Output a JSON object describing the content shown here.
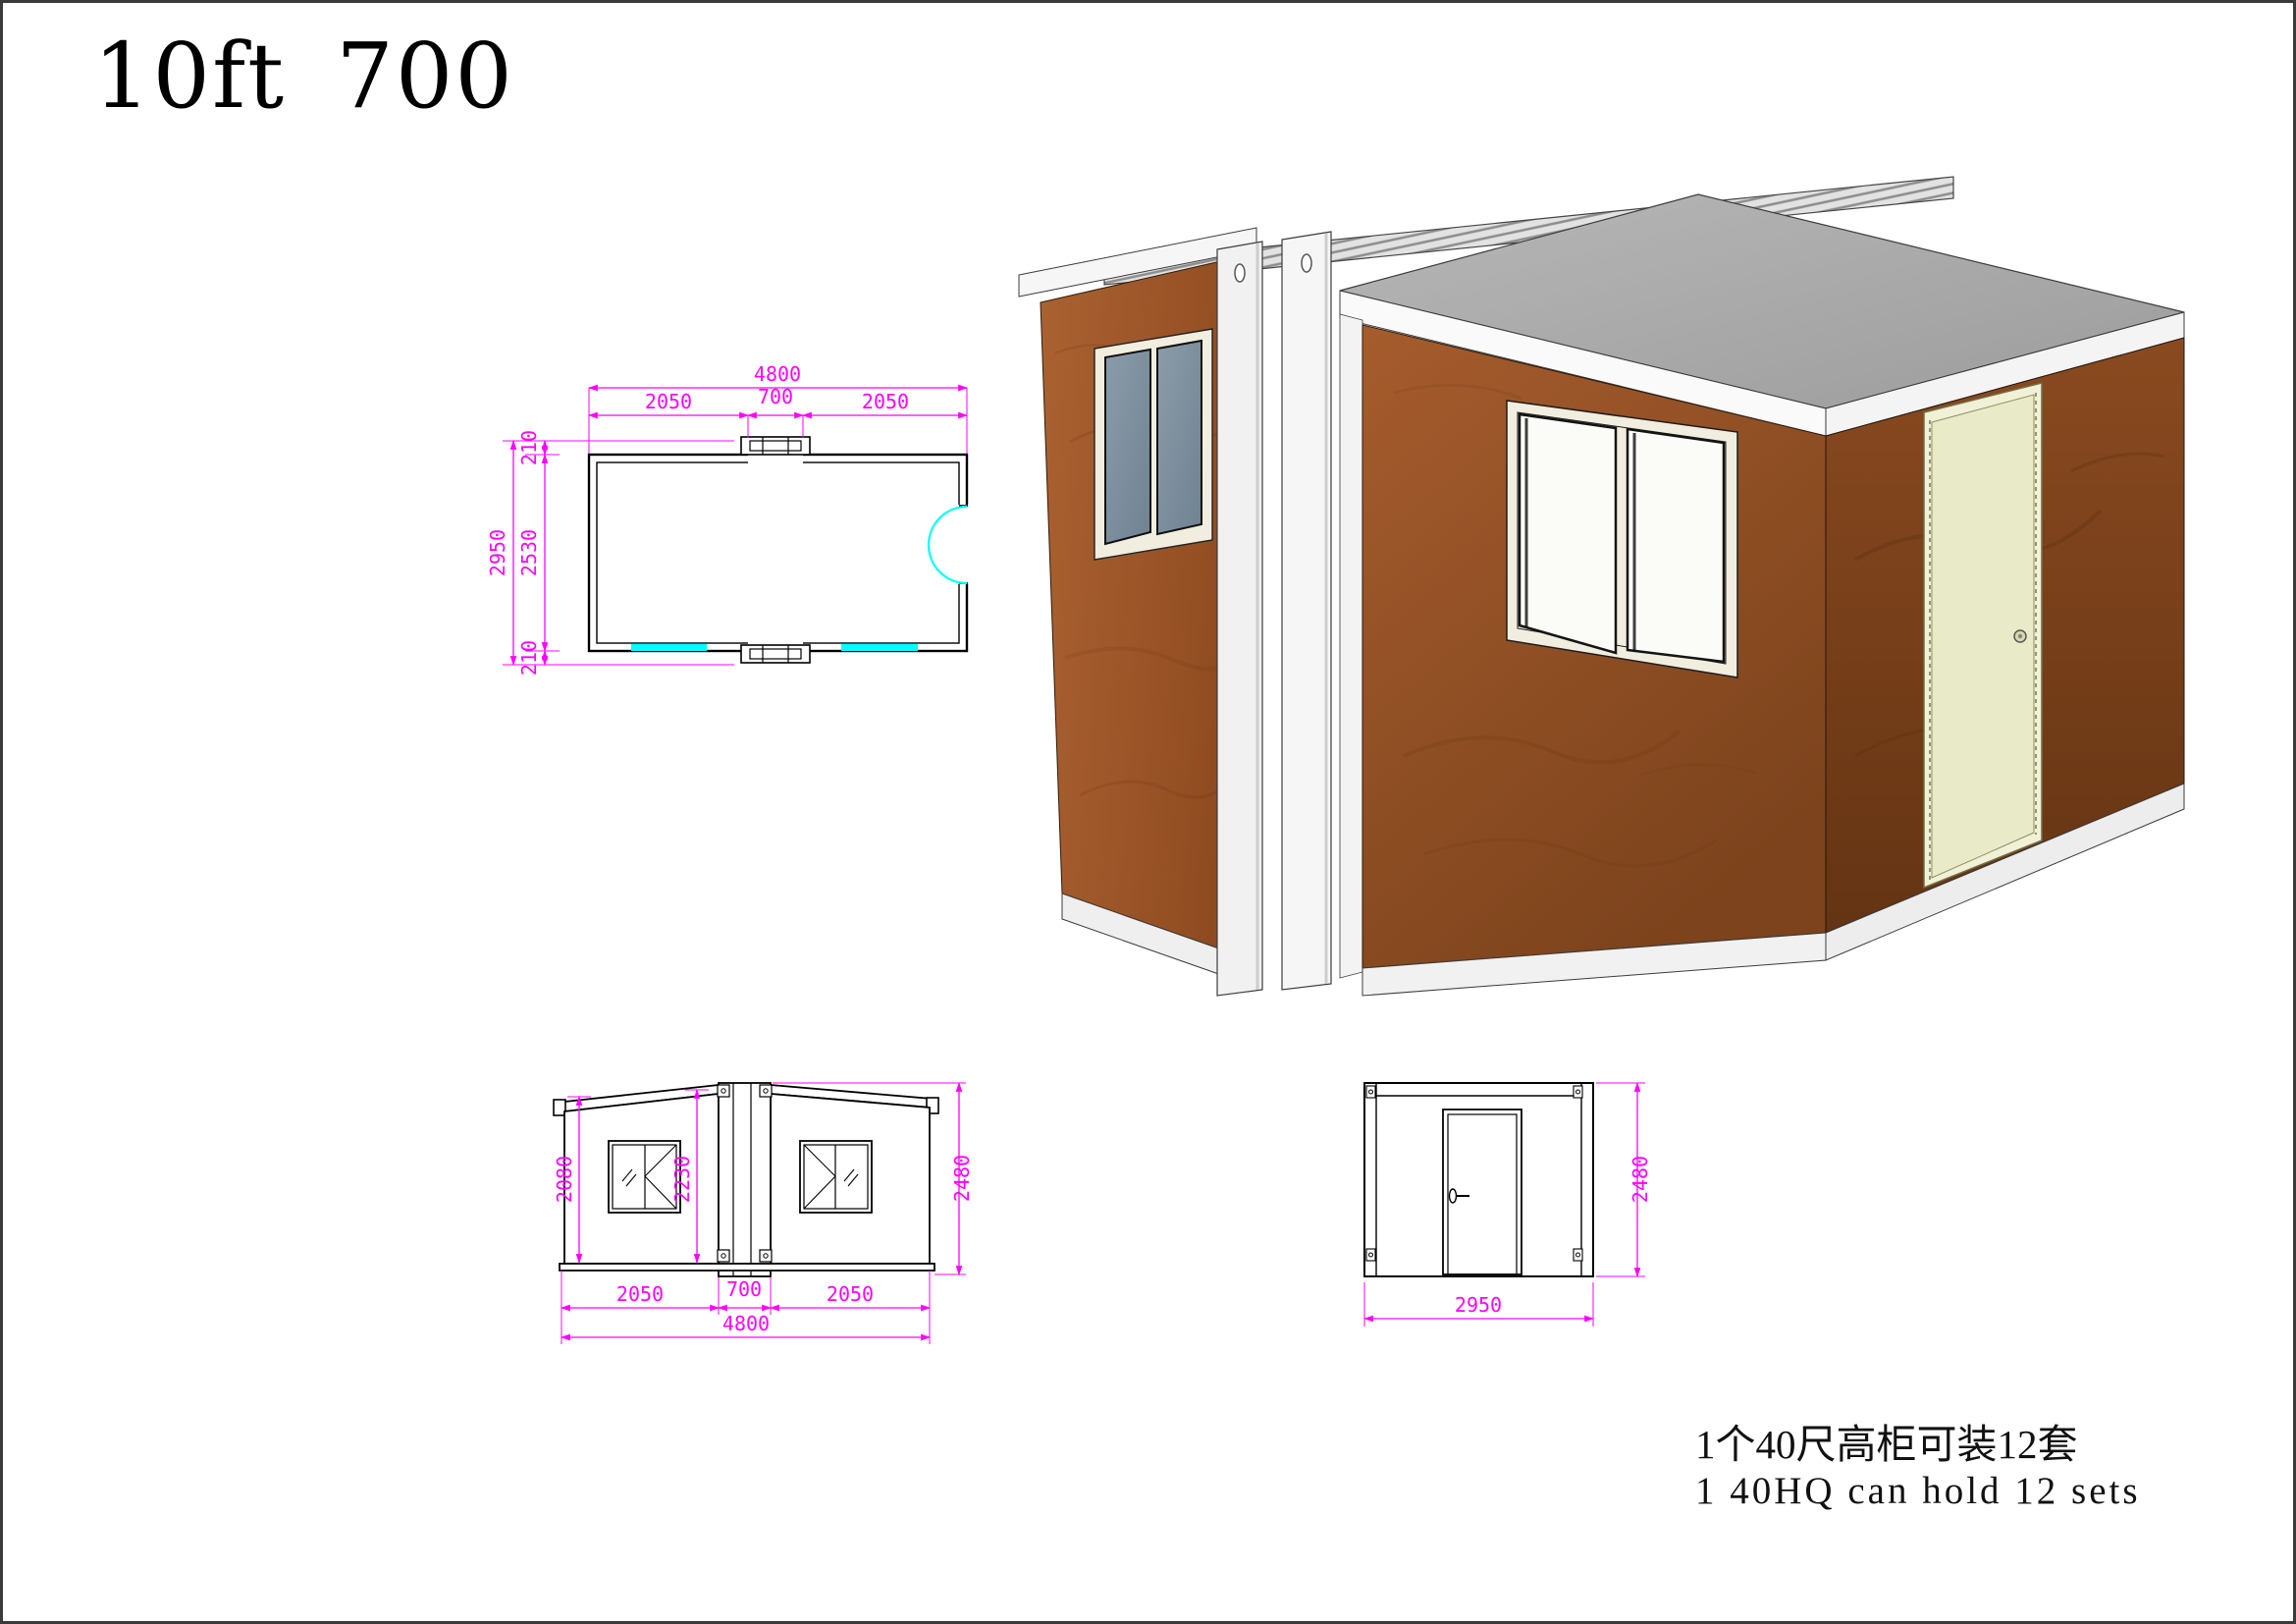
{
  "page": {
    "title": "10ft 700"
  },
  "colors": {
    "dimension_magenta": "#FF00FF",
    "window_marker_cyan": "#00FFFF",
    "drawing_line": "#000000",
    "wall_wood_brown": "#A0582B",
    "roof_gray": "#ABABAB",
    "trim_white": "#F4F4F4",
    "door_cream": "#E9EBC8",
    "glass_blue_gray": "#7E8E9B"
  },
  "floor_plan": {
    "total_width": "4800",
    "left_width": "2050",
    "center_width": "700",
    "right_width": "2050",
    "total_height": "2950",
    "top_offset": "210",
    "inner_height": "2530",
    "bottom_offset": "210"
  },
  "front_elevation": {
    "wall_height": "2080",
    "center_height": "2230",
    "overall_height": "2480",
    "left_width": "2050",
    "center_width": "700",
    "right_width": "2050",
    "total_width": "4800"
  },
  "side_elevation": {
    "width": "2950",
    "height": "2480"
  },
  "notes": {
    "capacity_zh": "1个40尺高柜可装12套",
    "capacity_en": "1 40HQ can hold 12 sets"
  }
}
